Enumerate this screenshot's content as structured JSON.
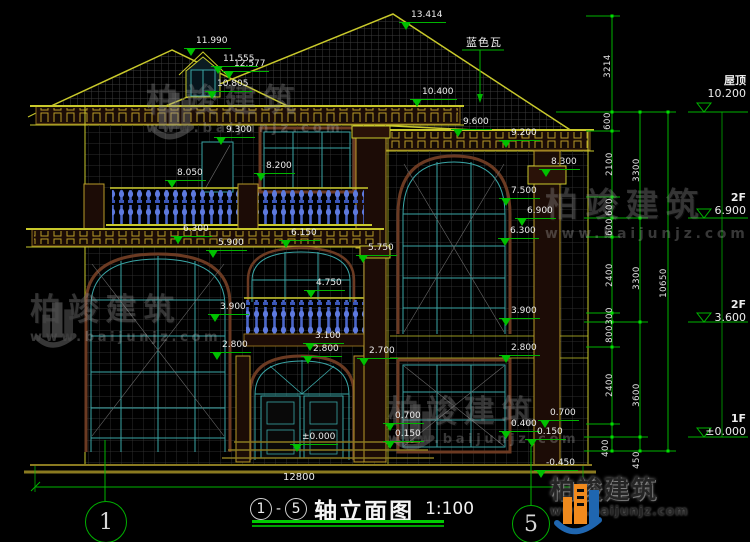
{
  "drawing": {
    "roof_note": "蓝色瓦",
    "bottom_width": "12800",
    "title": {
      "start_axis": "1",
      "separator": "-",
      "end_axis": "5",
      "name": "轴立面图",
      "scale": "1:100"
    }
  },
  "elevation_labels": [
    {
      "text": "12.577",
      "x": 222,
      "y": 59
    },
    {
      "text": "13.414",
      "x": 399,
      "y": 10
    },
    {
      "text": "11.990",
      "x": 184,
      "y": 36
    },
    {
      "text": "11.555",
      "x": 211,
      "y": 54
    },
    {
      "text": "10.805",
      "x": 205,
      "y": 79
    },
    {
      "text": "10.400",
      "x": 410,
      "y": 87
    },
    {
      "text": "9.300",
      "x": 214,
      "y": 125
    },
    {
      "text": "8.050",
      "x": 165,
      "y": 168
    },
    {
      "text": "8.200",
      "x": 254,
      "y": 161
    },
    {
      "text": "9.600",
      "x": 451,
      "y": 117
    },
    {
      "text": "9.200",
      "x": 499,
      "y": 128
    },
    {
      "text": "8.300",
      "x": 539,
      "y": 157
    },
    {
      "text": "7.500",
      "x": 499,
      "y": 186
    },
    {
      "text": "6.900",
      "x": 515,
      "y": 206
    },
    {
      "text": "6.300",
      "x": 498,
      "y": 226
    },
    {
      "text": "6.300",
      "x": 171,
      "y": 224
    },
    {
      "text": "5.900",
      "x": 206,
      "y": 238
    },
    {
      "text": "6.150",
      "x": 279,
      "y": 228
    },
    {
      "text": "5.750",
      "x": 356,
      "y": 243
    },
    {
      "text": "4.750",
      "x": 304,
      "y": 278
    },
    {
      "text": "3.900",
      "x": 208,
      "y": 302
    },
    {
      "text": "2.800",
      "x": 210,
      "y": 340
    },
    {
      "text": "3.100",
      "x": 303,
      "y": 331
    },
    {
      "text": "2.800",
      "x": 301,
      "y": 344
    },
    {
      "text": "2.700",
      "x": 357,
      "y": 346
    },
    {
      "text": "3.900",
      "x": 499,
      "y": 306
    },
    {
      "text": "2.800",
      "x": 499,
      "y": 343
    },
    {
      "text": "0.700",
      "x": 383,
      "y": 411
    },
    {
      "text": "0.150",
      "x": 383,
      "y": 429
    },
    {
      "text": "0.700",
      "x": 538,
      "y": 408
    },
    {
      "text": "0.400",
      "x": 499,
      "y": 419
    },
    {
      "text": "0.150",
      "x": 525,
      "y": 427
    },
    {
      "text": "±0.000",
      "x": 290,
      "y": 432
    },
    {
      "text": "-0.450",
      "x": 534,
      "y": 458
    }
  ],
  "right_levels": [
    {
      "name": "屋顶",
      "value": "10.200",
      "x": 688,
      "y": 74
    },
    {
      "name": "2F",
      "value": "6.900",
      "x": 688,
      "y": 191
    },
    {
      "name": "2F",
      "value": "3.600",
      "x": 688,
      "y": 298
    },
    {
      "name": "1F",
      "value": "±0.000",
      "x": 688,
      "y": 412
    }
  ],
  "vertical_dims": [
    {
      "text": "3214",
      "x": 608,
      "y": 66
    },
    {
      "text": "600",
      "x": 608,
      "y": 121
    },
    {
      "text": "2100",
      "x": 610,
      "y": 164
    },
    {
      "text": "600",
      "x": 610,
      "y": 207
    },
    {
      "text": "600",
      "x": 610,
      "y": 227
    },
    {
      "text": "2400",
      "x": 610,
      "y": 275
    },
    {
      "text": "300",
      "x": 610,
      "y": 316
    },
    {
      "text": "800",
      "x": 610,
      "y": 334
    },
    {
      "text": "2400",
      "x": 610,
      "y": 385
    },
    {
      "text": "400",
      "x": 606,
      "y": 448
    },
    {
      "text": "3300",
      "x": 637,
      "y": 170
    },
    {
      "text": "3300",
      "x": 637,
      "y": 278
    },
    {
      "text": "3600",
      "x": 637,
      "y": 395
    },
    {
      "text": "450",
      "x": 637,
      "y": 460
    },
    {
      "text": "10650",
      "x": 664,
      "y": 283
    }
  ],
  "axis_bubbles": [
    {
      "label": "1",
      "x": 106,
      "y": 522,
      "d": 42
    },
    {
      "label": "5",
      "x": 531,
      "y": 524,
      "d": 38
    }
  ],
  "watermarks": [
    {
      "text": "柏竣建筑",
      "url": "www.baijunjz.com",
      "x": 146,
      "y": 84,
      "size": 32,
      "icon": true
    },
    {
      "text": "柏竣建筑",
      "url": "www.baijunjz.com",
      "x": 545,
      "y": 188,
      "size": 33,
      "icon": false
    },
    {
      "text": "柏竣建筑",
      "url": "www.baijunjz.com",
      "x": 30,
      "y": 294,
      "size": 31,
      "icon": true
    },
    {
      "text": "柏竣建筑",
      "url": "www.baijunjz.com",
      "x": 388,
      "y": 396,
      "size": 31,
      "icon": true
    }
  ],
  "logo": {
    "name": "柏竣建筑",
    "url": "www.baijunjz.com"
  },
  "colors": {
    "background": "#000000",
    "dimension_green": "#00b400",
    "outline_yellow": "#c9c92b",
    "window_teal": "#3aa6a6",
    "baluster_blue": "#4a66c8",
    "cornice_brown": "#6b3a22",
    "label_white": "#ececec",
    "logo_orange": "#f08a1d",
    "logo_blue": "#1f66b0"
  }
}
